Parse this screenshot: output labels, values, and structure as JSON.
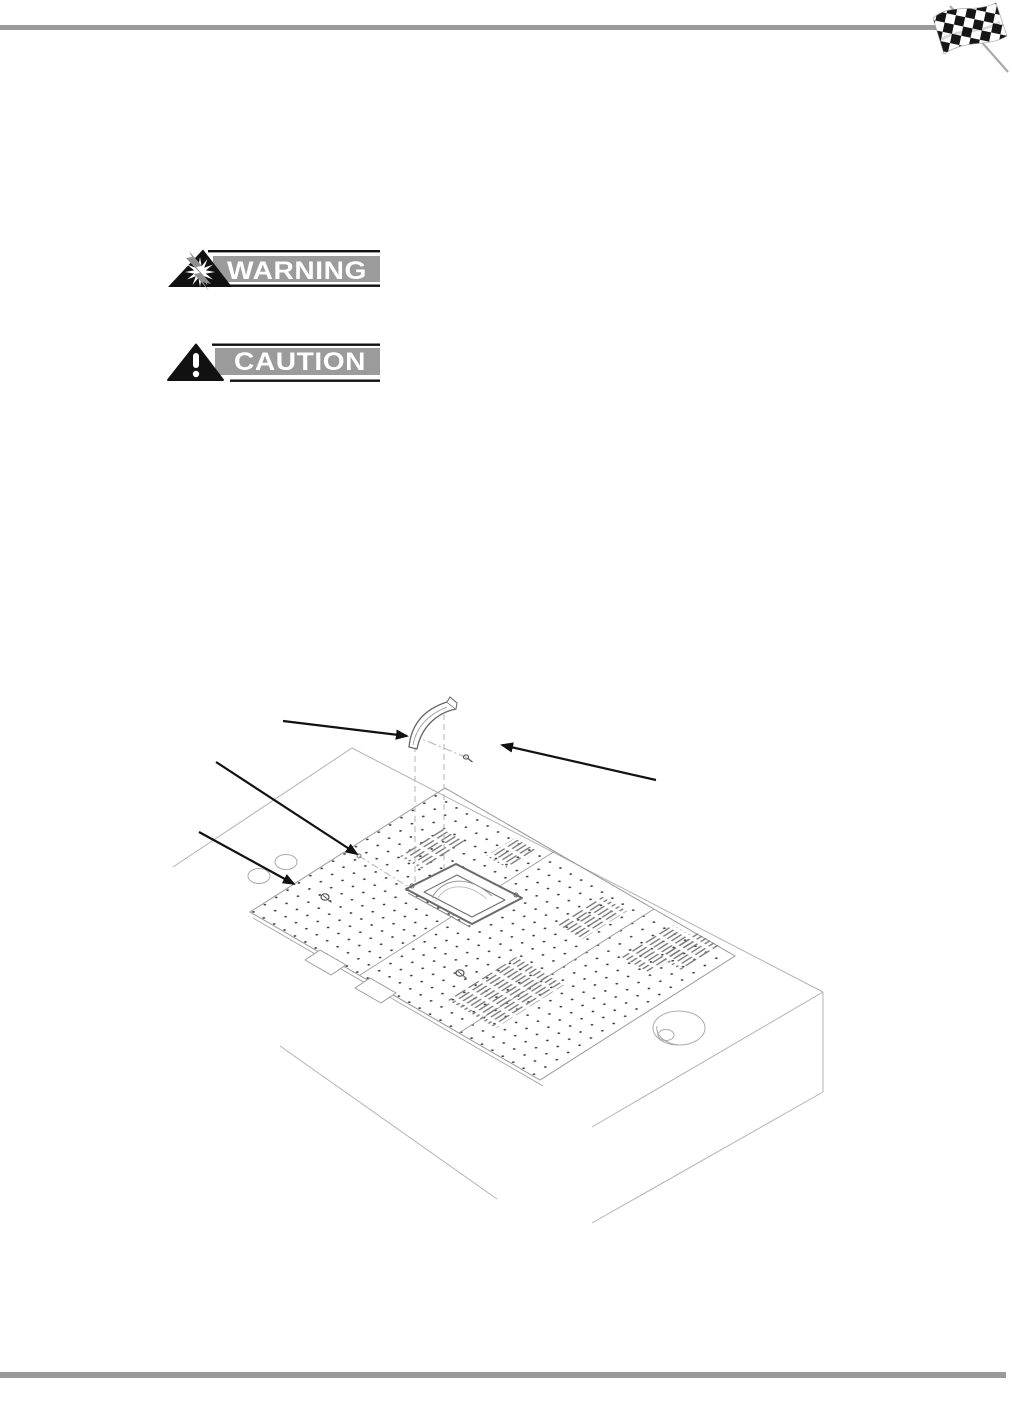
{
  "page": {
    "kind": "manual-page",
    "background_color": "#ffffff",
    "top_rule_color": "#9a9a9a",
    "bottom_rule_color": "#9a9a9a"
  },
  "header": {
    "flag_icon": "checkered-racing-flag-icon",
    "flag_colors": {
      "dark": "#161616",
      "light": "#ffffff",
      "pole": "#a9a9a9"
    }
  },
  "badges": {
    "warning": {
      "label": "WARNING",
      "icon": "lightning-burst-triangle-icon",
      "bar_color": "#9b9b9b",
      "rule_color": "#111111",
      "label_color": "#ffffff",
      "triangle_color": "#111111",
      "bolt_color": "#8f8f8f"
    },
    "caution": {
      "label": "CAUTION",
      "icon": "exclamation-triangle-icon",
      "bar_color": "#9b9b9b",
      "rule_color": "#111111",
      "label_color": "#ffffff",
      "triangle_color": "#111111"
    }
  },
  "figure": {
    "kind": "isometric-exploded-line-drawing",
    "callout_arrow_count": 4,
    "line_color": "#aeaeae",
    "panel_line_color": "#999999",
    "detail_color": "#666666",
    "dot_color": "#3f3f3f",
    "arrow_color": "#111111",
    "parts": [
      "mounting-bracket",
      "mounting-screw",
      "panel-screw",
      "perforated-panel-strip",
      "vent-slot-patches",
      "bezel-frame-opening",
      "cable-hole",
      "edge-notches",
      "small-holes"
    ]
  }
}
